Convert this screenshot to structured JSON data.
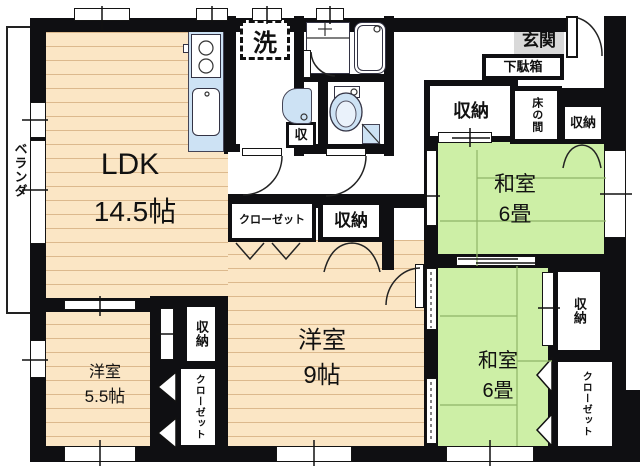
{
  "floorplan": {
    "rooms": {
      "ldk": {
        "name": "LDK",
        "size": "14.5帖"
      },
      "western_9": {
        "name": "洋室",
        "size": "9帖"
      },
      "western_55": {
        "name": "洋室",
        "size": "5.5帖"
      },
      "japanese_upper": {
        "name": "和室",
        "size": "6畳"
      },
      "japanese_lower": {
        "name": "和室",
        "size": "6畳"
      }
    },
    "labels": {
      "storage": "収納",
      "storage_short": "収",
      "closet": "クローゼット",
      "tokonoma": "床の間",
      "entrance": "玄関",
      "shoe_cabinet": "下駄箱",
      "laundry": "洗",
      "veranda": "ベランダ"
    },
    "colors": {
      "wall": "#0f0f12",
      "wood_floor": "#fbe6c5",
      "wood_line": "#dcb98d",
      "tatami": "#cdefa6",
      "tatami_line": "#8fb468",
      "fixture_blue": "#cde2f4",
      "genkan_gray": "#d9d9d9",
      "tokonoma_beige": "#f6dfb2",
      "outline": "#222222"
    }
  }
}
